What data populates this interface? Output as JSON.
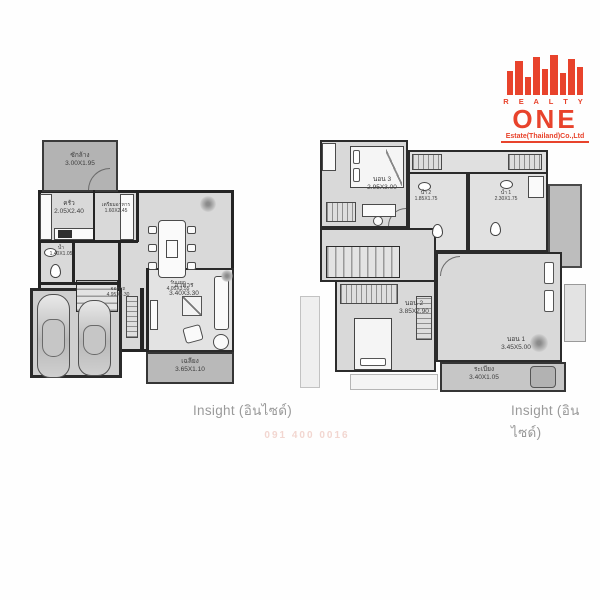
{
  "brand_color": "#e8432c",
  "logo": {
    "realty": "R E A L T Y",
    "one": "ONE",
    "estate": "Estate(Thailand)Co.,Ltd"
  },
  "captions": {
    "floor1": "Insight (อินไซด์)",
    "floor2": "Insight (อินไซด์)"
  },
  "floor1": {
    "rooms": {
      "laundry": {
        "name": "ซักล้าง",
        "size": "3.00X1.95"
      },
      "kitchen": {
        "name": "ครัว",
        "size": "2.05X2.40"
      },
      "pantry": {
        "name": "เตรียมอาหาร",
        "size": "1.60X2.45"
      },
      "dining": {
        "name": "อาหาร",
        "size": "3.40X3.30"
      },
      "bath": {
        "name": "น้ำ",
        "size": "1.40X1.05"
      },
      "living": {
        "name": "รับแขก",
        "size": "4.05X3.55"
      },
      "parking": {
        "name": "จอดรถ",
        "size": "4.95X4.30"
      },
      "terrace": {
        "name": "เฉลียง",
        "size": "3.65X1.10"
      }
    }
  },
  "floor2": {
    "rooms": {
      "bed3": {
        "name": "นอน 3",
        "size": "2.95X3.00"
      },
      "bath2": {
        "name": "น้ำ 2",
        "size": "1.85X1.75"
      },
      "bath1": {
        "name": "น้ำ 1",
        "size": "2.30X1.75"
      },
      "bed2": {
        "name": "นอน 2",
        "size": "3.85X2.90"
      },
      "bed1": {
        "name": "นอน 1",
        "size": "3.45X5.00"
      },
      "balcony": {
        "name": "ระเบียง",
        "size": "3.40X1.05"
      }
    }
  },
  "watermark": "091 400 0016"
}
